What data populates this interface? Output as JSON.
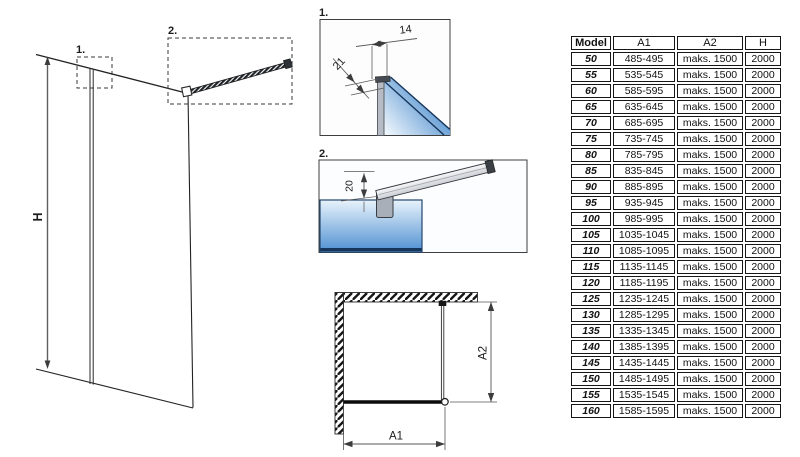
{
  "diagram": {
    "main_view": {
      "h_label": "H",
      "marker_1": "1.",
      "marker_2": "2."
    },
    "detail_1": {
      "label": "1.",
      "dim_top": "14",
      "dim_side": "21"
    },
    "detail_2": {
      "label": "2.",
      "dim_offset": "20"
    },
    "plan_view": {
      "dim_width": "A1",
      "dim_depth": "A2"
    }
  },
  "table": {
    "headers": [
      "Model",
      "A1",
      "A2",
      "H"
    ],
    "rows": [
      [
        "50",
        "485-495",
        "maks. 1500",
        "2000"
      ],
      [
        "55",
        "535-545",
        "maks. 1500",
        "2000"
      ],
      [
        "60",
        "585-595",
        "maks. 1500",
        "2000"
      ],
      [
        "65",
        "635-645",
        "maks. 1500",
        "2000"
      ],
      [
        "70",
        "685-695",
        "maks. 1500",
        "2000"
      ],
      [
        "75",
        "735-745",
        "maks. 1500",
        "2000"
      ],
      [
        "80",
        "785-795",
        "maks. 1500",
        "2000"
      ],
      [
        "85",
        "835-845",
        "maks. 1500",
        "2000"
      ],
      [
        "90",
        "885-895",
        "maks. 1500",
        "2000"
      ],
      [
        "95",
        "935-945",
        "maks. 1500",
        "2000"
      ],
      [
        "100",
        "985-995",
        "maks. 1500",
        "2000"
      ],
      [
        "105",
        "1035-1045",
        "maks. 1500",
        "2000"
      ],
      [
        "110",
        "1085-1095",
        "maks. 1500",
        "2000"
      ],
      [
        "115",
        "1135-1145",
        "maks. 1500",
        "2000"
      ],
      [
        "120",
        "1185-1195",
        "maks. 1500",
        "2000"
      ],
      [
        "125",
        "1235-1245",
        "maks. 1500",
        "2000"
      ],
      [
        "130",
        "1285-1295",
        "maks. 1500",
        "2000"
      ],
      [
        "135",
        "1335-1345",
        "maks. 1500",
        "2000"
      ],
      [
        "140",
        "1385-1395",
        "maks. 1500",
        "2000"
      ],
      [
        "145",
        "1435-1445",
        "maks. 1500",
        "2000"
      ],
      [
        "150",
        "1485-1495",
        "maks. 1500",
        "2000"
      ],
      [
        "155",
        "1535-1545",
        "maks. 1500",
        "2000"
      ],
      [
        "160",
        "1585-1595",
        "maks. 1500",
        "2000"
      ]
    ]
  },
  "colors": {
    "line": "#1f1f1f",
    "dimension": "#4a4a4a",
    "glass_light": "#e9f3fb",
    "glass_blue": "#4f8fd0",
    "glass_edge": "#16365c",
    "profile_gray": "#b7bcc4",
    "clamp_gray": "#a9afb8"
  }
}
